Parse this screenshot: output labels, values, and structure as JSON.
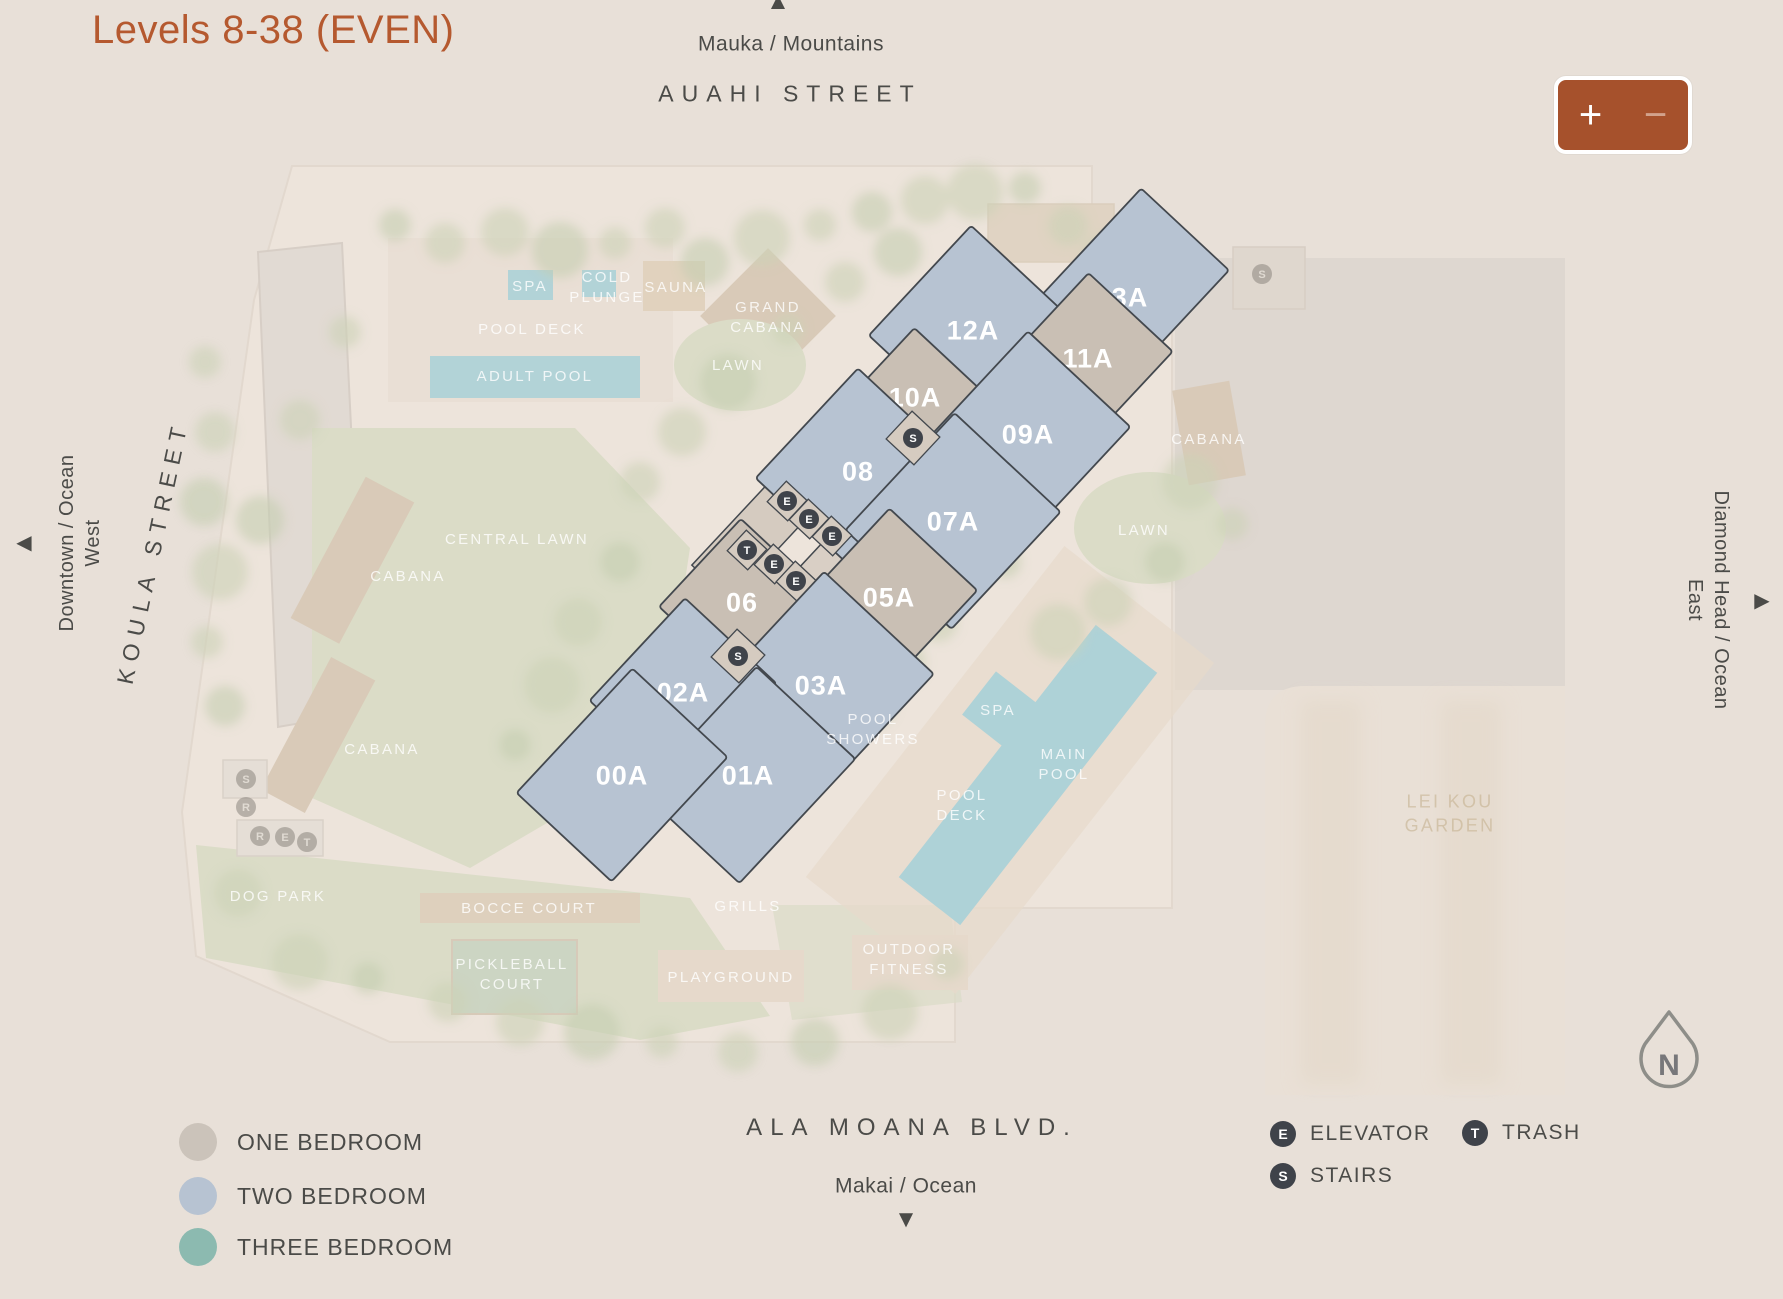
{
  "title": "Levels 8-38 (EVEN)",
  "orientation": {
    "mauka": "Mauka / Mountains",
    "auahi_street": "AUAHI STREET",
    "makai": "Makai / Ocean",
    "ala_moana_blvd": "ALA MOANA BLVD.",
    "koula_street": "KOULA STREET",
    "downtown": "Downtown / Ocean\nWest",
    "diamond_head": "Diamond Head / Ocean\nEast",
    "arrow_up": "▲",
    "arrow_down": "▼",
    "arrow_left": "◀",
    "arrow_right": "▶"
  },
  "zoom_controls": {
    "zoom_in": "+",
    "zoom_out": "−"
  },
  "compass": {
    "label": "N"
  },
  "legend_bedrooms": [
    {
      "label": "ONE BEDROOM",
      "color": "#cbc3ba"
    },
    {
      "label": "TWO BEDROOM",
      "color": "#b7c3d2"
    },
    {
      "label": "THREE BEDROOM",
      "color": "#8cbab0"
    }
  ],
  "legend_icons": [
    {
      "symbol": "E",
      "label": "ELEVATOR"
    },
    {
      "symbol": "T",
      "label": "TRASH"
    },
    {
      "symbol": "S",
      "label": "STAIRS"
    }
  ],
  "colors": {
    "background": "#e8e0d8",
    "title": "#b5592f",
    "text_dark": "#4b4b48",
    "one_bedroom": "#c9bfb4",
    "two_bedroom": "#b7c3d2",
    "three_bedroom": "#8cbab0",
    "unit_outline": "#43484e",
    "unit_label": "#ffffff",
    "icon_circle": "#3f434a",
    "zoom_button_bg": "#a6512c",
    "zoom_minus": "#d2a28c"
  },
  "units": [
    {
      "label": "13A",
      "type": "two-bedroom",
      "cx": 1122,
      "cy": 297,
      "w": 185,
      "h": 120
    },
    {
      "label": "12A",
      "type": "two-bedroom",
      "cx": 973,
      "cy": 330,
      "w": 150,
      "h": 145
    },
    {
      "label": "11A",
      "type": "one-bedroom",
      "cx": 1088,
      "cy": 358,
      "w": 125,
      "h": 115
    },
    {
      "label": "10A",
      "type": "one-bedroom",
      "cx": 915,
      "cy": 397,
      "w": 100,
      "h": 95
    },
    {
      "label": "09A",
      "type": "two-bedroom",
      "cx": 1028,
      "cy": 434,
      "w": 150,
      "h": 140
    },
    {
      "label": "08",
      "type": "two-bedroom",
      "cx": 858,
      "cy": 471,
      "w": 150,
      "h": 140
    },
    {
      "label": "07A",
      "type": "two-bedroom",
      "cx": 953,
      "cy": 521,
      "w": 160,
      "h": 145
    },
    {
      "label": "06",
      "type": "one-bedroom",
      "cx": 742,
      "cy": 602,
      "w": 120,
      "h": 115
    },
    {
      "label": "05A",
      "type": "one-bedroom",
      "cx": 889,
      "cy": 597,
      "w": 130,
      "h": 120
    },
    {
      "label": "03A",
      "type": "two-bedroom",
      "cx": 821,
      "cy": 685,
      "w": 170,
      "h": 150
    },
    {
      "label": "02A",
      "type": "two-bedroom",
      "cx": 683,
      "cy": 692,
      "w": 140,
      "h": 125
    },
    {
      "label": "01A",
      "type": "two-bedroom",
      "cx": 748,
      "cy": 775,
      "w": 170,
      "h": 135
    },
    {
      "label": "00A",
      "type": "two-bedroom",
      "cx": 622,
      "cy": 775,
      "w": 170,
      "h": 130
    }
  ],
  "map_icons": [
    {
      "symbol": "S",
      "x": 913,
      "y": 438
    },
    {
      "symbol": "E",
      "x": 787,
      "y": 501
    },
    {
      "symbol": "E",
      "x": 809,
      "y": 519
    },
    {
      "symbol": "E",
      "x": 832,
      "y": 536
    },
    {
      "symbol": "T",
      "x": 747,
      "y": 550
    },
    {
      "symbol": "E",
      "x": 774,
      "y": 564
    },
    {
      "symbol": "E",
      "x": 796,
      "y": 581
    },
    {
      "symbol": "S",
      "x": 738,
      "y": 656
    },
    {
      "symbol": "S",
      "x": 1262,
      "y": 274,
      "faded": true
    },
    {
      "symbol": "S",
      "x": 246,
      "y": 779,
      "faded": true
    },
    {
      "symbol": "R",
      "x": 246,
      "y": 807,
      "faded": true
    },
    {
      "symbol": "R",
      "x": 260,
      "y": 836,
      "faded": true
    },
    {
      "symbol": "E",
      "x": 285,
      "y": 837,
      "faded": true
    },
    {
      "symbol": "T",
      "x": 307,
      "y": 842,
      "faded": true
    }
  ],
  "background_labels": [
    {
      "text": "SPA",
      "x": 530,
      "y": 287
    },
    {
      "text": "COLD\nPLUNGE",
      "x": 607,
      "y": 288
    },
    {
      "text": "SAUNA",
      "x": 676,
      "y": 288
    },
    {
      "text": "GRAND\nCABANA",
      "x": 768,
      "y": 318
    },
    {
      "text": "POOL DECK",
      "x": 532,
      "y": 330
    },
    {
      "text": "ADULT POOL",
      "x": 535,
      "y": 377
    },
    {
      "text": "LAWN",
      "x": 738,
      "y": 366
    },
    {
      "text": "CENTRAL LAWN",
      "x": 517,
      "y": 540
    },
    {
      "text": "CABANA",
      "x": 408,
      "y": 577
    },
    {
      "text": "CABANA",
      "x": 382,
      "y": 750
    },
    {
      "text": "CABANA",
      "x": 1209,
      "y": 440
    },
    {
      "text": "LAWN",
      "x": 1144,
      "y": 531
    },
    {
      "text": "SPA",
      "x": 998,
      "y": 711
    },
    {
      "text": "MAIN\nPOOL",
      "x": 1064,
      "y": 765
    },
    {
      "text": "POOL\nDECK",
      "x": 962,
      "y": 806
    },
    {
      "text": "POOL\nSHOWERS",
      "x": 873,
      "y": 730
    },
    {
      "text": "DOG PARK",
      "x": 278,
      "y": 897
    },
    {
      "text": "BOCCE COURT",
      "x": 529,
      "y": 909
    },
    {
      "text": "GRILLS",
      "x": 748,
      "y": 907
    },
    {
      "text": "PICKLEBALL\nCOURT",
      "x": 512,
      "y": 975
    },
    {
      "text": "PLAYGROUND",
      "x": 731,
      "y": 978
    },
    {
      "text": "OUTDOOR\nFITNESS",
      "x": 909,
      "y": 960
    },
    {
      "text": "LEI KOU\nGARDEN",
      "x": 1450,
      "y": 814,
      "variant": "tan"
    }
  ]
}
